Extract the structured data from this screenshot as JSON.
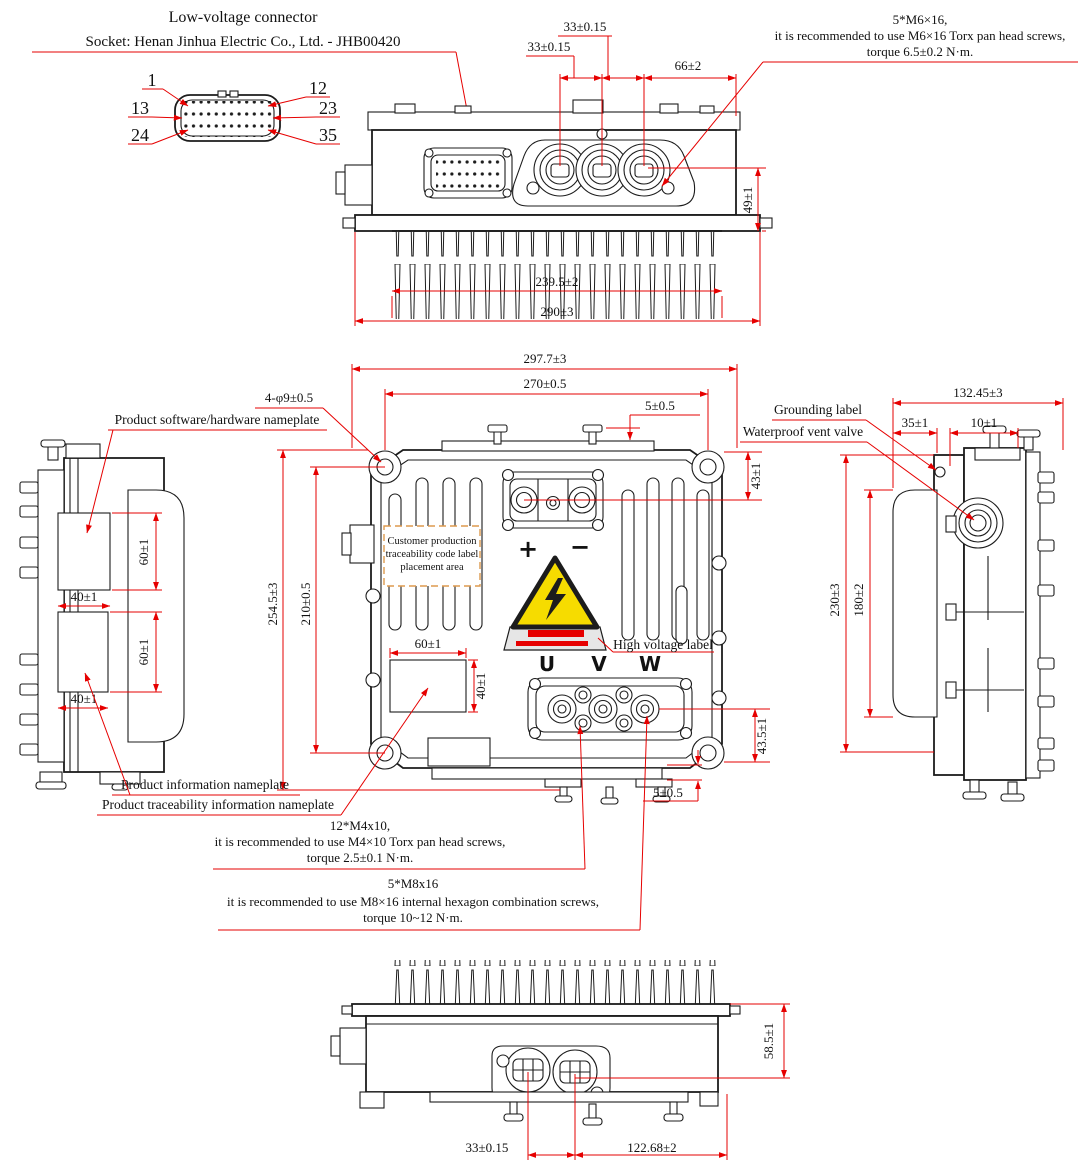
{
  "colors": {
    "line": "#1c1c1c",
    "dimension": "#e60000",
    "warning_yellow": "#f6dc00",
    "warning_red": "#e60000",
    "trace_box_border": "#dd9a4e",
    "label_plate_gray": "#e6e6e6"
  },
  "header": {
    "title": "Low-voltage connector",
    "subtitle": "Socket: Henan Jinhua Electric Co., Ltd. - JHB00420"
  },
  "pins": {
    "n1": "1",
    "n12": "12",
    "n13": "13",
    "n23": "23",
    "n24": "24",
    "n35": "35"
  },
  "notes": {
    "m6": {
      "l1": "5*M6×16,",
      "l2": "it is recommended to use M6×16 Torx pan head screws,",
      "l3": "torque 6.5±0.2 N·m."
    },
    "m4": {
      "l1": "12*M4x10,",
      "l2": "it is recommended to use M4×10 Torx pan head screws,",
      "l3": "torque 2.5±0.1 N·m."
    },
    "m8": {
      "l1": "5*M8x16",
      "l2": "it is recommended to use M8×16 internal hexagon combination screws,",
      "l3": "torque 10~12 N·m."
    }
  },
  "labels": {
    "software_nameplate": "Product software/hardware nameplate",
    "info_nameplate": "Product information nameplate",
    "trace_nameplate": "Product traceability information nameplate",
    "grounding": "Grounding label",
    "vent": "Waterproof vent valve",
    "high_voltage": "High voltage label",
    "trace_area_l1": "Customer production",
    "trace_area_l2": "traceability code label",
    "trace_area_l3": "placement area",
    "plus": "+",
    "minus": "−",
    "u": "U",
    "v": "V",
    "w": "W"
  },
  "dims": {
    "a33u": "33±0.15",
    "a33l": "33±0.15",
    "a66": "66±2",
    "a49": "49±1",
    "a239": "239.5±2",
    "a290": "290±3",
    "f2977": "297.7±3",
    "f270": "270±0.5",
    "f5": "5±0.5",
    "fphi": "4-φ9±0.5",
    "f43": "43±1",
    "f2545": "254.5±3",
    "f210": "210±0.5",
    "f60": "60±1",
    "f40": "40±1",
    "f435": "43.5±1",
    "f5b": "5±0.5",
    "l60a": "60±1",
    "l40a": "40±1",
    "l60b": "60±1",
    "l40b": "40±1",
    "r132": "132.45±3",
    "r35": "35±1",
    "r10": "10±1",
    "r230": "230±3",
    "r180": "180±2",
    "b585": "58.5±1",
    "b33": "33±0.15",
    "b122": "122.68±2"
  }
}
